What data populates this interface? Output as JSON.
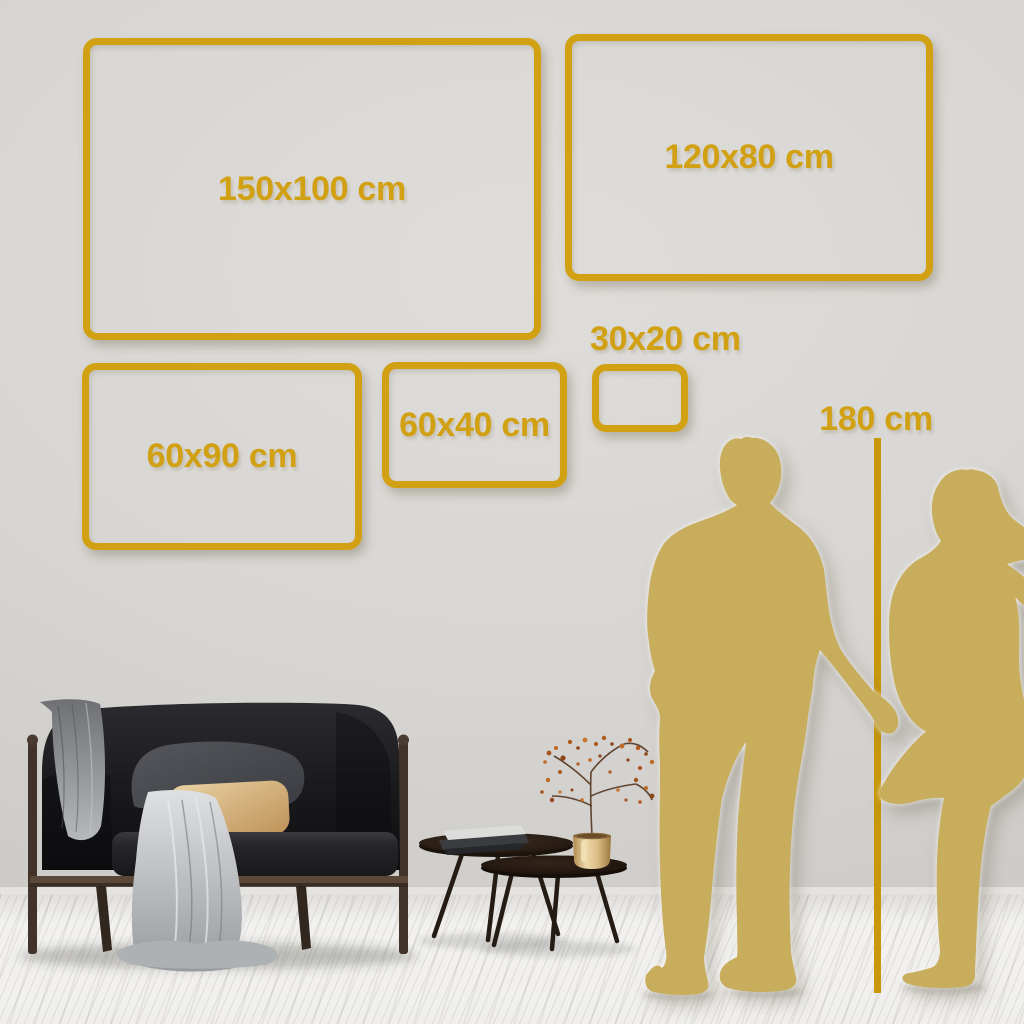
{
  "palette": {
    "gold": "#D2A013",
    "line-gold": "#C8980A",
    "silhouette": "#C8AD5C",
    "wall": "#D7D5D2",
    "floor": "#F1F0EE"
  },
  "frames": [
    {
      "label": "150x100 cm",
      "width_cm": 150,
      "height_cm": 100
    },
    {
      "label": "120x80 cm",
      "width_cm": 120,
      "height_cm": 80
    },
    {
      "label": "60x90 cm",
      "width_cm": 90,
      "height_cm": 60
    },
    {
      "label": "60x40 cm",
      "width_cm": 60,
      "height_cm": 40
    },
    {
      "label": "30x20 cm",
      "width_cm": 30,
      "height_cm": 20
    }
  ],
  "height_marker": {
    "label": "180 cm",
    "height_cm": 180
  },
  "scene": {
    "figures": [
      "man-silhouette",
      "woman-silhouette"
    ],
    "furniture": [
      "sofa",
      "throw-blanket",
      "gray-pillow",
      "beige-pillow",
      "coffee-table-large",
      "coffee-table-small",
      "books",
      "gold-vase",
      "dried-branch"
    ]
  }
}
